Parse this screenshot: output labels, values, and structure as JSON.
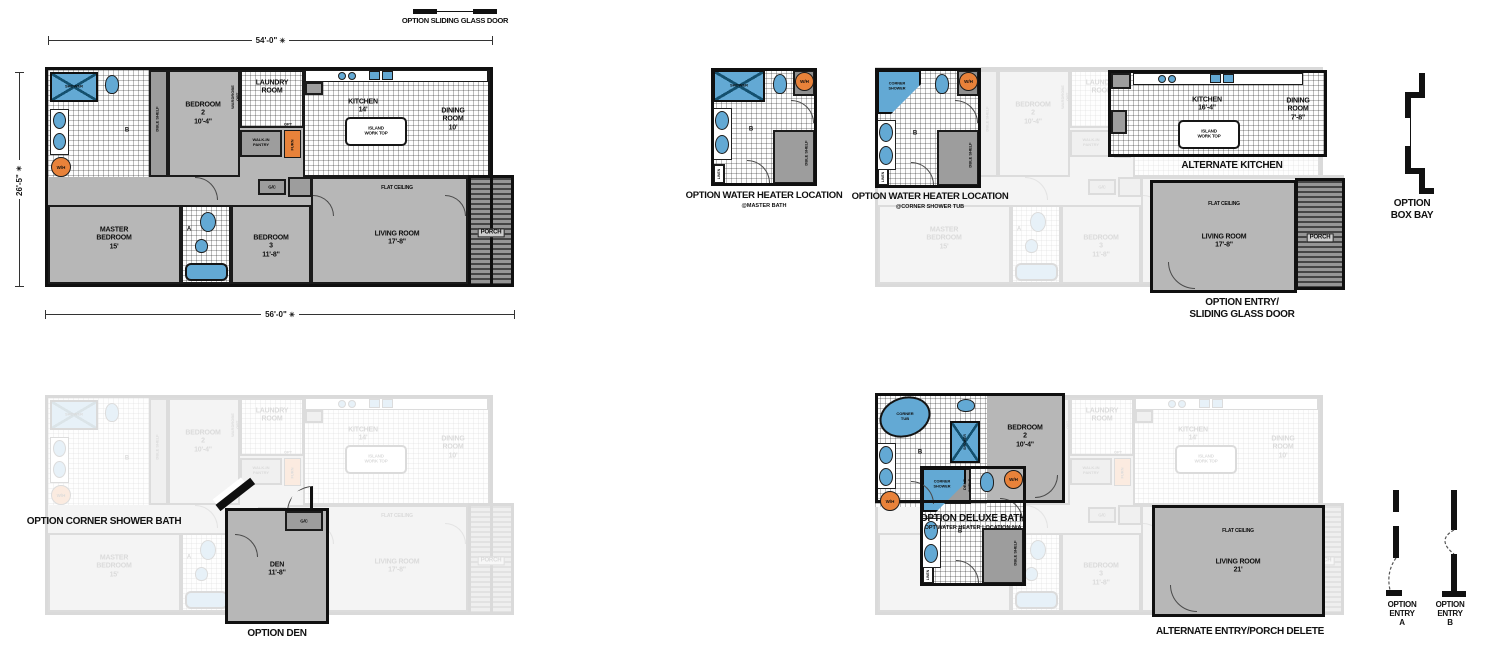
{
  "colors": {
    "wall": "#101010",
    "carpet": "#b7b7b7",
    "fixture_blue": "#63a9d4",
    "fixture_orange": "#e8823a",
    "porch_dark": "#454545"
  },
  "annotations": {
    "option_sliding_glass_door": "OPTION SLIDING GLASS DOOR"
  },
  "dims": {
    "top": "54'-0\"",
    "left": "26'-5\"",
    "bottom": "56'-0\"",
    "star": "✳"
  },
  "plan": {
    "shower": "SHOWER",
    "bath_b": "B",
    "wh": "W/H",
    "dble_shelf": "DBLE SHELF",
    "wardrobe_opt": "WARDROBE\nOPT",
    "bedroom2": "BEDROOM\n2\n10'-4\"",
    "laundry": "LAUNDRY\nROOM",
    "walkin_pantry": "WALK-IN\nPANTRY",
    "furn": "FURN",
    "opt": "OPT",
    "kitchen": "KITCHEN\n14'",
    "island": "ISLAND\nWORK TOP",
    "dining": "DINING\nROOM\n10'",
    "flat_ceiling": "FLAT CEILING",
    "gc": "G/C",
    "master": "MASTER\nBEDROOM\n15'",
    "bath_a": "A",
    "bedroom3": "BEDROOM\n3\n11'-8\"",
    "living": "LIVING ROOM\n17'-8\"",
    "porch": "PORCH"
  },
  "options": {
    "wh_master": {
      "title": "OPTION WATER HEATER LOCATION",
      "subtitle": "@MASTER BATH",
      "shower": "SHOWER",
      "wh": "W/H",
      "b": "B",
      "dble_shelf": "DBLE SHELF",
      "linen": "LINEN"
    },
    "wh_corner": {
      "title": "OPTION WATER HEATER LOCATION",
      "subtitle": "@CORNER SHOWER TUB",
      "corner_shower": "CORNER\nSHOWER",
      "wh": "W/H",
      "b": "B",
      "dble_shelf": "DBLE SHELF",
      "linen": "LINEN"
    },
    "alt_kitchen": {
      "title": "ALTERNATE KITCHEN",
      "kitchen": "KITCHEN\n16'-4\"",
      "island": "ISLAND\nWORK TOP",
      "dining": "DINING\nROOM\n7'-8\""
    },
    "entry_sgd": {
      "title": "OPTION ENTRY/\nSLIDING GLASS DOOR",
      "living": "LIVING ROOM\n17'-8\"",
      "flat_ceiling": "FLAT CEILING",
      "porch": "PORCH"
    },
    "box_bay": {
      "title": "OPTION\nBOX BAY"
    },
    "corner_shower_bath": {
      "title": "OPTION CORNER SHOWER BATH"
    },
    "den": {
      "title": "OPTION DEN",
      "room": "DEN\n11'-8\"",
      "gc": "G/C"
    },
    "deluxe_bath": {
      "title": "OPTION DELUXE BATH",
      "subtitle": "OPT WATER HEATER LOCATION N/A",
      "corner_tub": "CORNER\nTUB",
      "shower": "SHOWER",
      "b": "B",
      "wh": "W/H",
      "dble_shelf": "DBLE SHELF",
      "bedroom2": "BEDROOM\n2\n10'-4\""
    },
    "alt_entry": {
      "title": "ALTERNATE ENTRY/PORCH DELETE",
      "living": "LIVING ROOM\n21'",
      "flat_ceiling": "FLAT CEILING"
    },
    "entry_a": {
      "title": "OPTION\nENTRY\nA"
    },
    "entry_b": {
      "title": "OPTION\nENTRY\nB"
    }
  }
}
